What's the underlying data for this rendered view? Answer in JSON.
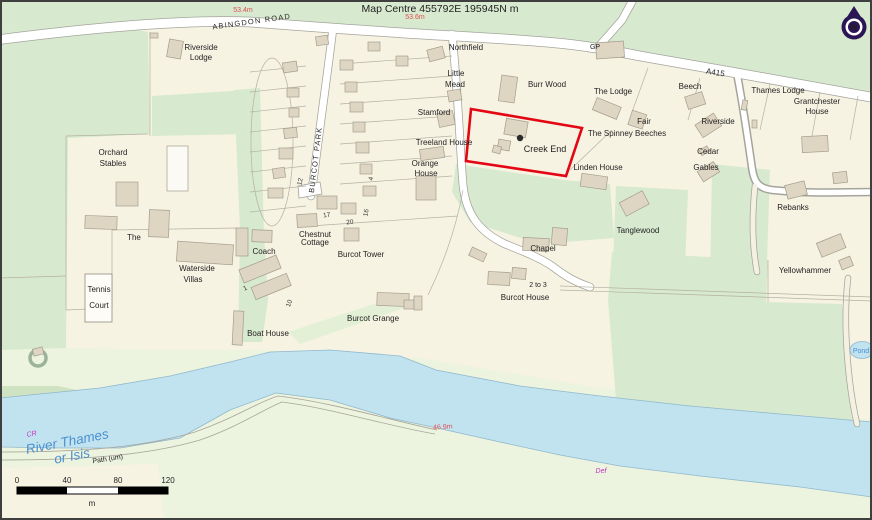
{
  "map": {
    "title": "Map Centre 455792E 195945N m",
    "north_label": "N"
  },
  "roads": {
    "abingdon_road": "ABINGDON ROAD",
    "a415": "A415",
    "burcot_park": "BURCOT PARK",
    "gp": "GP"
  },
  "spot_heights": {
    "h534": "53.4m",
    "h536": "53.6m",
    "h469": "46.9m"
  },
  "water": {
    "river_line1": "River Thames",
    "river_line2": "or Isis",
    "cr": "CR",
    "def": "Def",
    "pond": "Pond"
  },
  "paths": {
    "path_um": "Path (um)"
  },
  "places": {
    "riverside_lodge_1": "Riverside",
    "riverside_lodge_2": "Lodge",
    "northfield": "Northfield",
    "little": "Little",
    "mead": "Mead",
    "stamford": "Stamford",
    "burr_wood": "Burr Wood",
    "the_lodge": "The Lodge",
    "beech": "Beech",
    "thames_lodge": "Thames Lodge",
    "grantchester_1": "Grantchester",
    "grantchester_2": "House",
    "fair": "Fair",
    "spinney_beeches": "The Spinney Beeches",
    "riverside_east": "Riverside",
    "treeland_house": "Treeland House",
    "creek_end": "Creek End",
    "cedar": "Cedar",
    "linden_house": "Linden House",
    "orange_1": "Orange",
    "orange_2": "House",
    "gables": "Gables",
    "rebanks": "Rebanks",
    "orchard_1": "Orchard",
    "orchard_2": "Stables",
    "the": "The",
    "tennis_1": "Tennis",
    "tennis_2": "Court",
    "waterside_1": "Waterside",
    "waterside_2": "Villas",
    "coach": "Coach",
    "chestnut_1": "Chestnut",
    "chestnut_2": "Cottage",
    "burcot_tower": "Burcot Tower",
    "chapel": "Chapel",
    "tanglewood": "Tanglewood",
    "two_to_three": "2 to 3",
    "burcot_house": "Burcot House",
    "burcot_grange": "Burcot Grange",
    "boat_house": "Boat House",
    "yellowhammer": "Yellowhammer"
  },
  "house_numbers": {
    "n12": "12",
    "n4": "4",
    "n16": "16",
    "n17": "17",
    "n20": "20",
    "n1": "1",
    "n10": "10"
  },
  "scale_bar": {
    "t0": "0",
    "t40": "40",
    "t80": "80",
    "t120": "120",
    "unit": "m"
  },
  "colors": {
    "plot_outline_red": "#e30613",
    "field_green": "#d7e9cf",
    "bank_green": "#ecf3de",
    "river_blue": "#c1e3f0",
    "land_cream": "#f7f3e3",
    "building_tan": "#ded5c2",
    "north_arrow_navy": "#2b1655",
    "spot_height_red": "#de5151",
    "admin_magenta": "#c233c2",
    "water_text_blue": "#4a8fd0"
  }
}
